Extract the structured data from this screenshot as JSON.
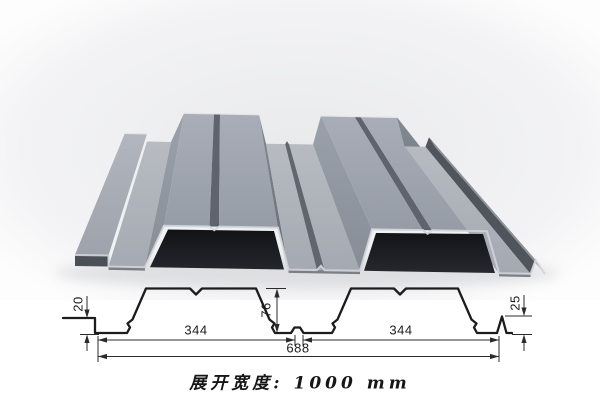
{
  "figure": {
    "type": "steel-floor-deck-profile",
    "caption": "展开宽度: 1000 mm",
    "dimensions": {
      "left_edge_height": "20",
      "rib_height": "76",
      "right_edge_height": "25",
      "left_span": "344",
      "right_span": "344",
      "total_span": "688"
    },
    "colors": {
      "steel_gray": "#959aa4",
      "steel_top": "#9aa0aa",
      "cavity_dark": "#15171b",
      "drawing_line": "#1c1c1c",
      "background": "#ffffff"
    }
  }
}
